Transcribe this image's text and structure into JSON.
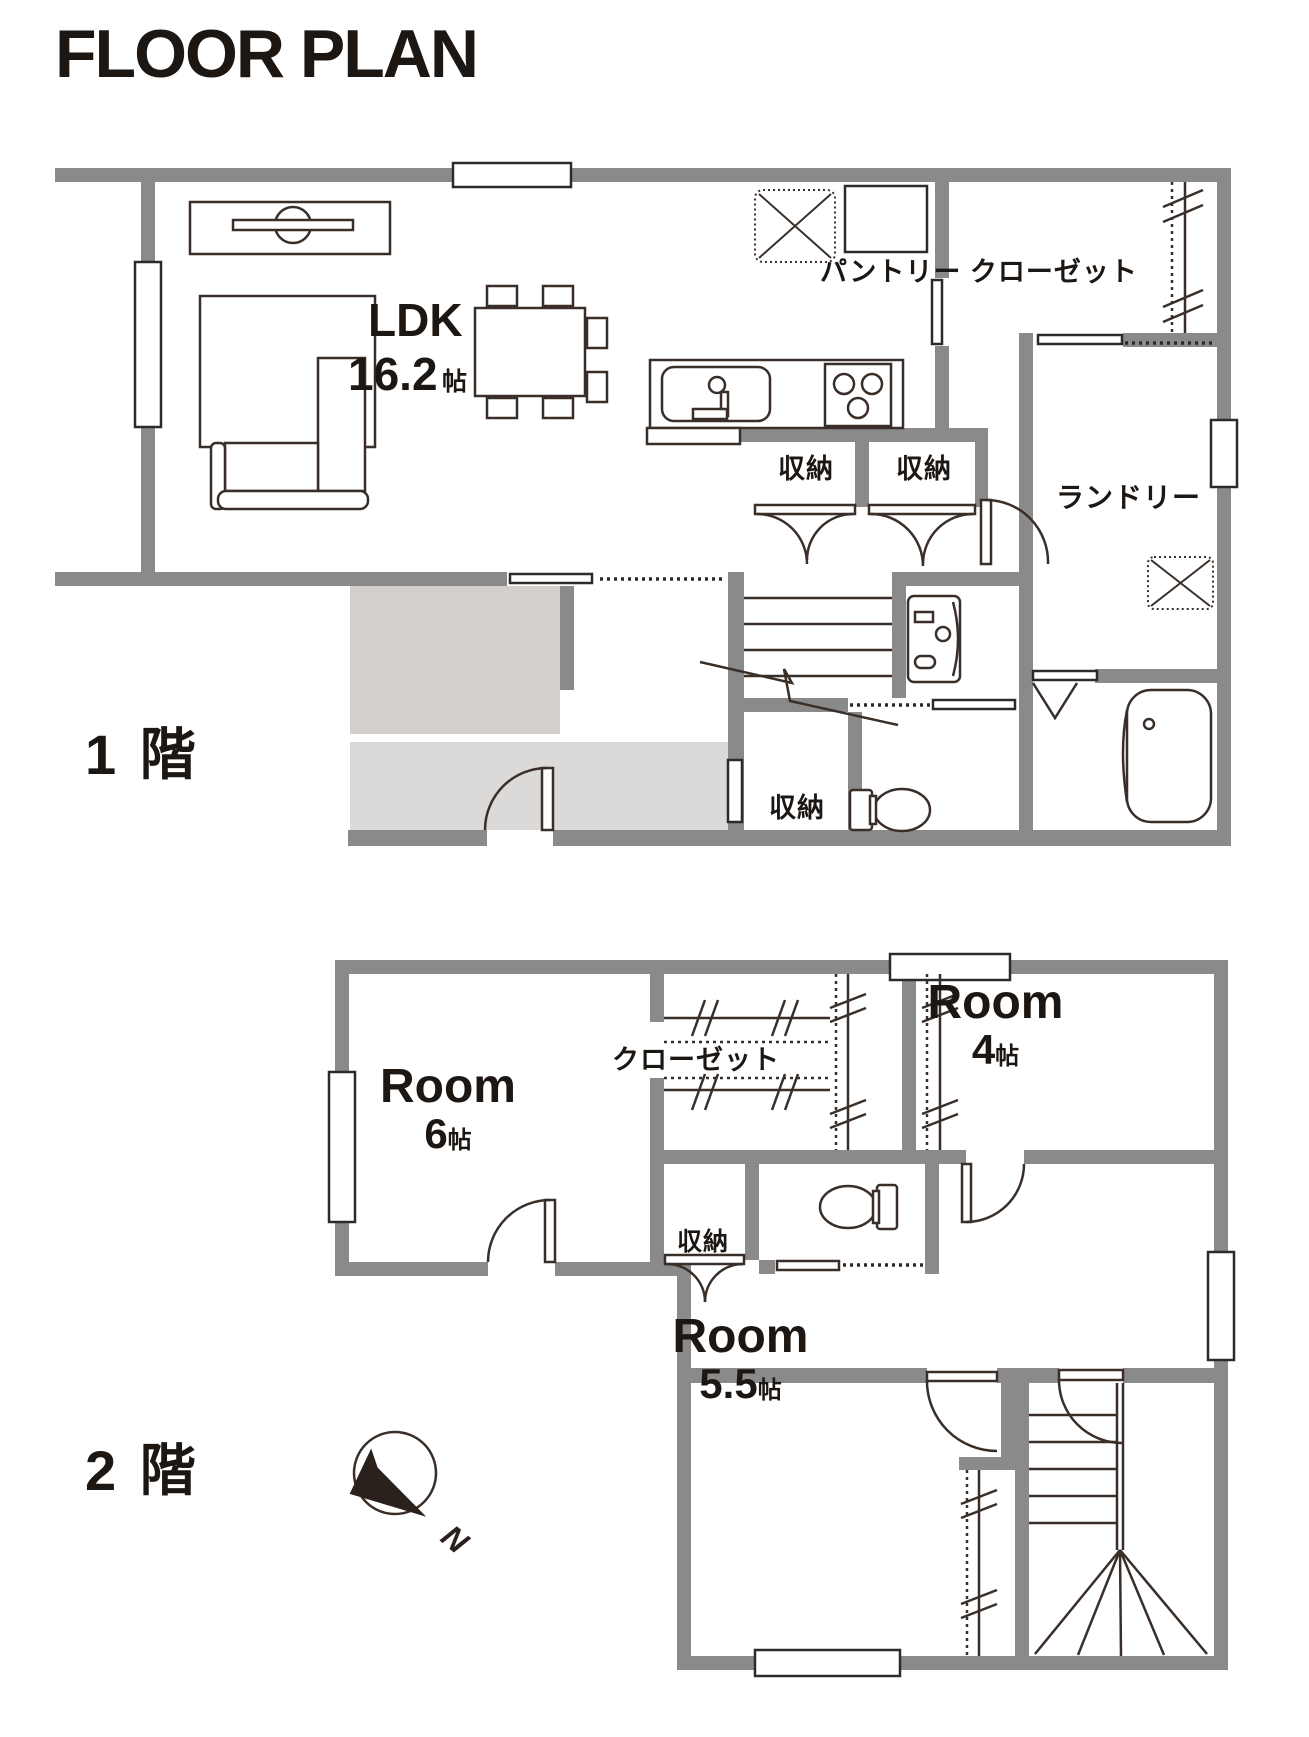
{
  "title": "FLOOR PLAN",
  "colors": {
    "wall": "#8a8a8a",
    "fixture_line": "#3a2f28",
    "text": "#1d1713",
    "entrance_hall_fill": "#d2cfcd",
    "entrance_step_fill": "#dcdad8",
    "window_fill": "#ffffff"
  },
  "floor1": {
    "name": "1 階",
    "ldk": {
      "label": "LDK",
      "area": "16.2",
      "unit": "帖"
    },
    "pantry_label": "パントリー クローゼット",
    "storage1": "収納",
    "storage2": "収納",
    "storage_under_stairs": "収納",
    "laundry_label": "ランドリー"
  },
  "floor2": {
    "name": "2 階",
    "room6": {
      "label": "Room",
      "area": "6",
      "unit": "帖"
    },
    "room4": {
      "label": "Room",
      "area": "4",
      "unit": "帖"
    },
    "room55": {
      "label": "Room",
      "area": "5.5",
      "unit": "帖"
    },
    "closet_label": "クローゼット",
    "storage_label": "収納",
    "compass_n": "N"
  }
}
